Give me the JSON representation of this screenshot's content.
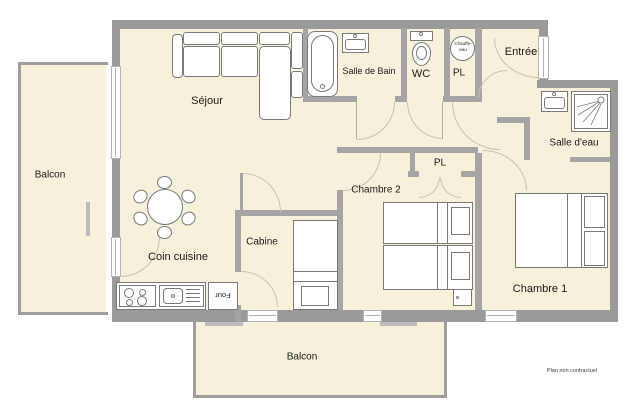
{
  "plan": {
    "title": "Apartment floor plan",
    "footnote": "Plan non contractuel"
  },
  "colors": {
    "floor": "#F7F0DB",
    "exterior_wall": "#9A9A9A",
    "interior_wall": "#A5A5A5",
    "door_arc": "#C9C2AD",
    "furniture_outline": "#7A7A7A",
    "label_text": "#1B1B1B"
  },
  "rooms": {
    "balcon_left": {
      "label": "Balcon"
    },
    "sejour": {
      "label": "Séjour"
    },
    "salle_de_bain": {
      "label": "Salle de Bain"
    },
    "wc": {
      "label": "WC"
    },
    "pl_entree": {
      "label": "PL"
    },
    "entree": {
      "label": "Entrée"
    },
    "salle_deau": {
      "label": "Salle d'eau"
    },
    "chambre2": {
      "label": "Chambre 2"
    },
    "pl_chambre2": {
      "label": "PL"
    },
    "cabine": {
      "label": "Cabine"
    },
    "coin_cuisine": {
      "label": "Coin cuisine"
    },
    "chambre1": {
      "label": "Chambre 1"
    },
    "balcon_bottom": {
      "label": "Balcon"
    }
  },
  "fixtures": {
    "chauffe_eau": {
      "label": "Chauffe-eau"
    },
    "four": {
      "label": "Four"
    }
  }
}
